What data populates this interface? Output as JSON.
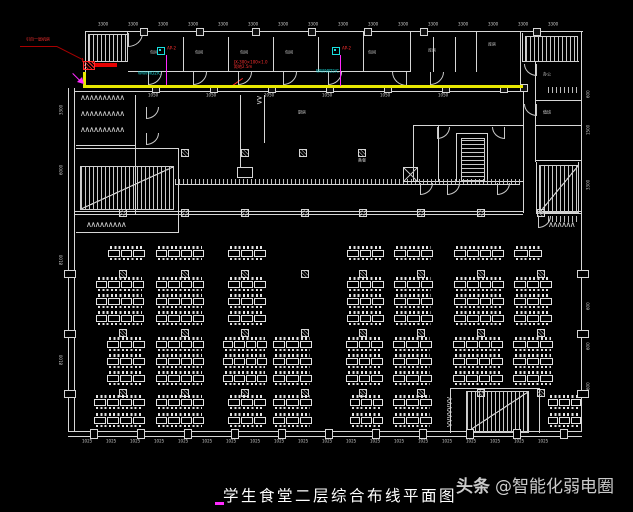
{
  "meta": {
    "caption": "学生食堂二层综合布线平面图",
    "watermark_bold": "头条",
    "watermark_rest": "@智能化弱电圈"
  },
  "colors": {
    "bg": "#000000",
    "wall": "#d6d6d6",
    "tray": "#e8e800",
    "red": "#ff3030",
    "darkred": "#a80000",
    "magenta": "#ff2aff",
    "cyan": "#19e0e0",
    "caption_text": "#ffffff",
    "watermark_text": "#cbcbcb"
  },
  "annotations": {
    "feed_label": "引自一层机房",
    "tray_label_1": "JX-300×100×1.0",
    "tray_label_2": "距地2.5m",
    "ap_label": "AP-2",
    "cable_label": "WW/WD2/C"
  },
  "plan": {
    "walls": [
      [
        85,
        31,
        498,
        1
      ],
      [
        581,
        31,
        1,
        401
      ],
      [
        68,
        431,
        514,
        1
      ],
      [
        68,
        436,
        514,
        1
      ],
      [
        68,
        88,
        1,
        344
      ],
      [
        74,
        88,
        1,
        344
      ],
      [
        85,
        31,
        1,
        42
      ],
      [
        85,
        61,
        43,
        1
      ],
      [
        127,
        31,
        1,
        31
      ],
      [
        128,
        71,
        283,
        1
      ],
      [
        74,
        91,
        450,
        1
      ],
      [
        183,
        37,
        1,
        35
      ],
      [
        228,
        37,
        1,
        35
      ],
      [
        273,
        37,
        1,
        35
      ],
      [
        318,
        37,
        1,
        35
      ],
      [
        363,
        31,
        1,
        41
      ],
      [
        410,
        31,
        1,
        41
      ],
      [
        433,
        37,
        1,
        35
      ],
      [
        455,
        37,
        1,
        35
      ],
      [
        476,
        31,
        1,
        41
      ],
      [
        520,
        31,
        1,
        57
      ],
      [
        522,
        61,
        57,
        1
      ],
      [
        522,
        33,
        1,
        29
      ],
      [
        535,
        62,
        1,
        100
      ],
      [
        535,
        100,
        46,
        1
      ],
      [
        535,
        125,
        46,
        1
      ],
      [
        535,
        160,
        46,
        1
      ],
      [
        536,
        162,
        1,
        52
      ],
      [
        578,
        162,
        1,
        52
      ],
      [
        536,
        213,
        45,
        1
      ],
      [
        523,
        88,
        1,
        125
      ],
      [
        135,
        95,
        1,
        119
      ],
      [
        76,
        145,
        59,
        1
      ],
      [
        76,
        148,
        102,
        1
      ],
      [
        178,
        148,
        1,
        85
      ],
      [
        76,
        232,
        102,
        1
      ],
      [
        240,
        95,
        1,
        73
      ],
      [
        264,
        95,
        1,
        48
      ],
      [
        74,
        211,
        449,
        1
      ],
      [
        74,
        214,
        449,
        1
      ],
      [
        536,
        211,
        45,
        1
      ],
      [
        413,
        125,
        110,
        1
      ],
      [
        413,
        181,
        110,
        1
      ],
      [
        413,
        125,
        1,
        57
      ],
      [
        438,
        125,
        1,
        57
      ],
      [
        456,
        133,
        32,
        1
      ],
      [
        456,
        133,
        1,
        49
      ],
      [
        487,
        133,
        1,
        49
      ],
      [
        450,
        388,
        90,
        1
      ],
      [
        450,
        388,
        1,
        45
      ],
      [
        539,
        388,
        1,
        45
      ],
      [
        175,
        184,
        345,
        1
      ],
      [
        237,
        167,
        16,
        1
      ],
      [
        237,
        177,
        16,
        1
      ],
      [
        237,
        167,
        1,
        10
      ],
      [
        252,
        167,
        1,
        10
      ]
    ],
    "hatches": [
      [
        175,
        179,
        345,
        5
      ],
      [
        548,
        87,
        32,
        6
      ],
      [
        548,
        216,
        32,
        6
      ]
    ],
    "diags": [
      [
        57,
        46,
        30,
        27,
        "darkred"
      ],
      [
        231,
        86,
        14,
        -35,
        "red"
      ],
      [
        73,
        73,
        14,
        45,
        "magenta"
      ]
    ],
    "stairs": [
      {
        "x": 88,
        "y": 34,
        "w": 38,
        "h": 26,
        "dir": "v",
        "diag": 0
      },
      {
        "x": 525,
        "y": 36,
        "w": 51,
        "h": 24,
        "dir": "v",
        "diag": 0
      },
      {
        "x": 80,
        "y": 166,
        "w": 92,
        "h": 42,
        "dir": "v",
        "diag": 1
      },
      {
        "x": 539,
        "y": 165,
        "w": 38,
        "h": 46,
        "dir": "v",
        "diag": 1
      },
      {
        "x": 466,
        "y": 391,
        "w": 61,
        "h": 40,
        "dir": "v",
        "diag": 1
      },
      {
        "x": 461,
        "y": 138,
        "w": 22,
        "h": 42,
        "dir": "h",
        "diag": 0
      }
    ],
    "doors": [
      [
        128,
        33,
        13,
        ""
      ],
      [
        148,
        72,
        12,
        ""
      ],
      [
        193,
        72,
        12,
        ""
      ],
      [
        238,
        72,
        12,
        ""
      ],
      [
        283,
        72,
        12,
        ""
      ],
      [
        328,
        72,
        12,
        ""
      ],
      [
        392,
        72,
        13,
        "x"
      ],
      [
        430,
        72,
        12,
        ""
      ],
      [
        524,
        64,
        11,
        "x"
      ],
      [
        524,
        104,
        11,
        "x"
      ],
      [
        420,
        183,
        11,
        ""
      ],
      [
        447,
        183,
        11,
        ""
      ],
      [
        497,
        183,
        11,
        ""
      ],
      [
        146,
        107,
        11,
        ""
      ],
      [
        146,
        133,
        11,
        ""
      ],
      [
        437,
        127,
        11,
        ""
      ],
      [
        492,
        127,
        11,
        "x"
      ],
      [
        538,
        216,
        11,
        ""
      ]
    ],
    "columns": [
      [
        181,
        149
      ],
      [
        241,
        149
      ],
      [
        299,
        149
      ],
      [
        358,
        149
      ],
      [
        119,
        209
      ],
      [
        181,
        209
      ],
      [
        241,
        209
      ],
      [
        301,
        209
      ],
      [
        359,
        209
      ],
      [
        417,
        209
      ],
      [
        477,
        209
      ],
      [
        537,
        209
      ],
      [
        119,
        270
      ],
      [
        181,
        270
      ],
      [
        241,
        270
      ],
      [
        301,
        270
      ],
      [
        359,
        270
      ],
      [
        417,
        270
      ],
      [
        477,
        270
      ],
      [
        537,
        270
      ],
      [
        119,
        329
      ],
      [
        181,
        329
      ],
      [
        241,
        329
      ],
      [
        301,
        329
      ],
      [
        359,
        329
      ],
      [
        417,
        329
      ],
      [
        477,
        329
      ],
      [
        537,
        329
      ],
      [
        119,
        389
      ],
      [
        181,
        389
      ],
      [
        241,
        389
      ],
      [
        301,
        389
      ],
      [
        359,
        389
      ],
      [
        417,
        389
      ],
      [
        477,
        389
      ],
      [
        537,
        389
      ]
    ],
    "marks": [
      [
        152,
        85
      ],
      [
        210,
        85
      ],
      [
        268,
        85
      ],
      [
        326,
        85
      ],
      [
        384,
        85
      ],
      [
        442,
        85
      ],
      [
        500,
        85
      ],
      [
        140,
        28
      ],
      [
        196,
        28
      ],
      [
        252,
        28
      ],
      [
        308,
        28
      ],
      [
        364,
        28
      ],
      [
        420,
        28
      ],
      [
        533,
        28
      ],
      [
        520,
        84
      ]
    ],
    "mullions": [
      [
        90,
        429,
        6,
        8
      ],
      [
        137,
        429,
        6,
        8
      ],
      [
        184,
        429,
        6,
        8
      ],
      [
        231,
        429,
        6,
        8
      ],
      [
        278,
        429,
        6,
        8
      ],
      [
        325,
        429,
        6,
        8
      ],
      [
        372,
        429,
        6,
        8
      ],
      [
        419,
        429,
        6,
        8
      ],
      [
        466,
        429,
        6,
        8
      ],
      [
        513,
        429,
        6,
        8
      ],
      [
        560,
        429,
        6,
        8
      ],
      [
        64,
        270,
        10,
        6
      ],
      [
        64,
        330,
        10,
        6
      ],
      [
        64,
        390,
        10,
        6
      ],
      [
        577,
        270,
        10,
        6
      ],
      [
        577,
        330,
        10,
        6
      ],
      [
        577,
        390,
        10,
        6
      ]
    ],
    "fixtures": [
      [
        80,
        95,
        48,
        0
      ],
      [
        80,
        111,
        48,
        0
      ],
      [
        80,
        127,
        48,
        0
      ],
      [
        86,
        222,
        44,
        0
      ],
      [
        548,
        222,
        28,
        0
      ],
      [
        452,
        396,
        34,
        90
      ],
      [
        262,
        95,
        12,
        90
      ]
    ],
    "xboxes": [
      [
        403,
        167,
        13,
        13
      ]
    ],
    "tiny_labels": [
      [
        150,
        50,
        "包间"
      ],
      [
        195,
        50,
        "包间"
      ],
      [
        240,
        50,
        "包间"
      ],
      [
        285,
        50,
        "包间"
      ],
      [
        368,
        50,
        "包间"
      ],
      [
        428,
        48,
        "库房"
      ],
      [
        488,
        42,
        "库房"
      ],
      [
        543,
        72,
        "办公"
      ],
      [
        543,
        110,
        "值班"
      ],
      [
        298,
        110,
        "厨房"
      ],
      [
        358,
        158,
        "备餐"
      ],
      [
        148,
        93,
        "1050"
      ],
      [
        206,
        93,
        "1050"
      ],
      [
        264,
        93,
        "1050"
      ],
      [
        322,
        93,
        "1050"
      ],
      [
        380,
        93,
        "1050"
      ],
      [
        438,
        93,
        "1050"
      ]
    ],
    "dims": {
      "top": {
        "y": 22,
        "x0": 98,
        "step": 30,
        "n": 16,
        "t": "3300"
      },
      "bottom": {
        "y": 439,
        "x0": 82,
        "step": 24,
        "n": 20,
        "t": "1025"
      },
      "left": [
        [
          59,
          115,
          "3300"
        ],
        [
          59,
          175,
          "6000"
        ],
        [
          59,
          265,
          "8100"
        ],
        [
          59,
          365,
          "8100"
        ]
      ],
      "right": [
        [
          586,
          98,
          "600"
        ],
        [
          586,
          135,
          "1500"
        ],
        [
          586,
          190,
          "3300"
        ],
        [
          586,
          310,
          "600"
        ],
        [
          586,
          350,
          "600"
        ],
        [
          586,
          390,
          "600"
        ]
      ]
    },
    "tray": {
      "v": [
        83,
        72,
        3,
        14
      ],
      "h": [
        83,
        85,
        440,
        3
      ]
    },
    "tables": {
      "strip_h": 14,
      "rows": [
        {
          "y": 246,
          "segs": [
            [
              108,
              37
            ],
            [
              156,
              48
            ],
            [
              228,
              38
            ],
            [
              347,
              37
            ],
            [
              394,
              39
            ],
            [
              454,
              50
            ],
            [
              514,
              28
            ]
          ]
        },
        {
          "y": 277,
          "segs": [
            [
              96,
              48
            ],
            [
              156,
              48
            ],
            [
              228,
              38
            ],
            [
              347,
              37
            ],
            [
              394,
              39
            ],
            [
              454,
              50
            ],
            [
              514,
              38
            ]
          ]
        },
        {
          "y": 294,
          "segs": [
            [
              96,
              48
            ],
            [
              156,
              48
            ],
            [
              228,
              38
            ],
            [
              347,
              37
            ],
            [
              394,
              39
            ],
            [
              454,
              50
            ],
            [
              514,
              38
            ]
          ]
        },
        {
          "y": 311,
          "segs": [
            [
              96,
              48
            ],
            [
              156,
              48
            ],
            [
              228,
              38
            ],
            [
              347,
              37
            ],
            [
              394,
              39
            ],
            [
              454,
              50
            ],
            [
              514,
              38
            ]
          ]
        },
        {
          "y": 337,
          "segs": [
            [
              107,
              38
            ],
            [
              156,
              48
            ],
            [
              223,
              44
            ],
            [
              273,
              39
            ],
            [
              346,
              37
            ],
            [
              393,
              39
            ],
            [
              453,
              50
            ],
            [
              513,
              40
            ]
          ]
        },
        {
          "y": 354,
          "segs": [
            [
              107,
              38
            ],
            [
              156,
              48
            ],
            [
              223,
              44
            ],
            [
              273,
              39
            ],
            [
              346,
              37
            ],
            [
              393,
              39
            ],
            [
              453,
              50
            ],
            [
              513,
              40
            ]
          ]
        },
        {
          "y": 371,
          "segs": [
            [
              107,
              38
            ],
            [
              156,
              48
            ],
            [
              223,
              44
            ],
            [
              273,
              39
            ],
            [
              346,
              37
            ],
            [
              393,
              39
            ],
            [
              453,
              50
            ],
            [
              513,
              40
            ]
          ]
        },
        {
          "y": 395,
          "segs": [
            [
              94,
              51
            ],
            [
              156,
              48
            ],
            [
              228,
              38
            ],
            [
              273,
              39
            ],
            [
              350,
              33
            ],
            [
              393,
              39
            ],
            [
              548,
              33
            ]
          ]
        },
        {
          "y": 413,
          "segs": [
            [
              94,
              51
            ],
            [
              156,
              48
            ],
            [
              228,
              38
            ],
            [
              273,
              39
            ],
            [
              350,
              33
            ],
            [
              393,
              39
            ],
            [
              548,
              33
            ]
          ]
        }
      ]
    }
  }
}
